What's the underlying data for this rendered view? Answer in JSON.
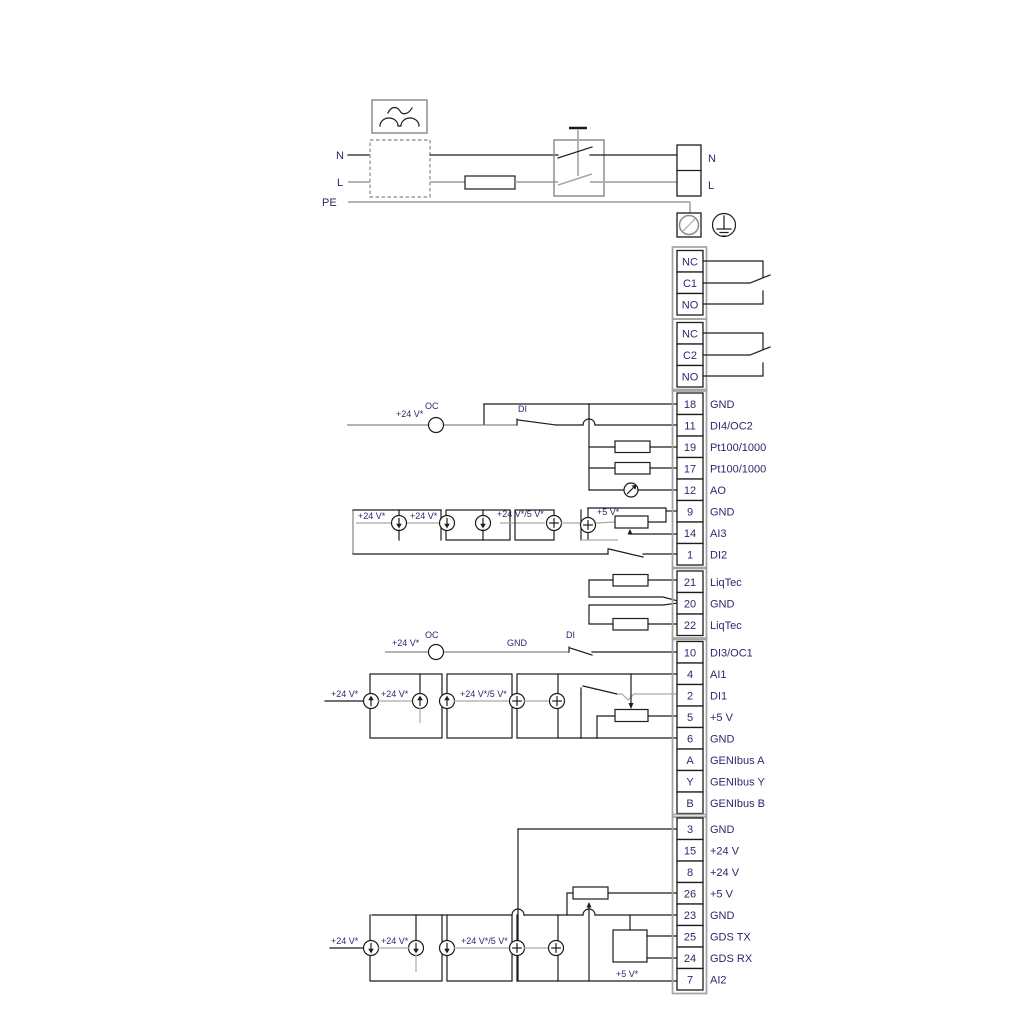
{
  "title": "pump-wiring-terminal-diagram",
  "colors": {
    "line_black": "#1c1c1c",
    "line_gray": "#a9a9a9",
    "text_navy": "#29296e",
    "housing_gray": "#a3a3a3",
    "background": "#ffffff"
  },
  "power": {
    "n_in": "N",
    "l_in": "L",
    "pe": "PE",
    "n_out": "N",
    "l_out": "L"
  },
  "relays": {
    "r1": [
      "NC",
      "C1",
      "NO"
    ],
    "r2": [
      "NC",
      "C2",
      "NO"
    ]
  },
  "terminals": {
    "main": [
      {
        "pin": "18",
        "label": "GND"
      },
      {
        "pin": "11",
        "label": "DI4/OC2"
      },
      {
        "pin": "19",
        "label": "Pt100/1000"
      },
      {
        "pin": "17",
        "label": "Pt100/1000"
      },
      {
        "pin": "12",
        "label": "AO"
      },
      {
        "pin": "9",
        "label": "GND"
      },
      {
        "pin": "14",
        "label": "AI3"
      },
      {
        "pin": "1",
        "label": "DI2"
      }
    ],
    "liqtec": [
      {
        "pin": "21",
        "label": "LiqTec"
      },
      {
        "pin": "20",
        "label": "GND"
      },
      {
        "pin": "22",
        "label": "LiqTec"
      }
    ],
    "io": [
      {
        "pin": "10",
        "label": "DI3/OC1"
      },
      {
        "pin": "4",
        "label": "AI1"
      },
      {
        "pin": "2",
        "label": "DI1"
      },
      {
        "pin": "5",
        "label": "+5 V"
      },
      {
        "pin": "6",
        "label": "GND"
      },
      {
        "pin": "A",
        "label": "GENIbus A"
      },
      {
        "pin": "Y",
        "label": "GENIbus Y"
      },
      {
        "pin": "B",
        "label": "GENIbus B"
      }
    ],
    "comm": [
      {
        "pin": "3",
        "label": "GND"
      },
      {
        "pin": "15",
        "label": "+24 V"
      },
      {
        "pin": "8",
        "label": "+24 V"
      },
      {
        "pin": "26",
        "label": "+5 V"
      },
      {
        "pin": "23",
        "label": "GND"
      },
      {
        "pin": "25",
        "label": "GDS TX"
      },
      {
        "pin": "24",
        "label": "GDS RX"
      },
      {
        "pin": "7",
        "label": "AI2"
      }
    ]
  },
  "ann": {
    "r18_v24": "+24 V*",
    "r18_oc": "OC",
    "r18_di": "DI",
    "r9_v24a": "+24 V*",
    "r9_v24b": "+24 V*",
    "r9_mix": "+24 V*/5 V*",
    "r9_v5": "+5 V*",
    "r10_v24": "+24 V*",
    "r10_oc": "OC",
    "r10_gnd": "GND",
    "r10_di": "DI",
    "r4_v24a": "+24 V*",
    "r4_v24b": "+24 V*",
    "r4_mix": "+24 V*/5 V*",
    "rb_v24a": "+24 V*",
    "rb_v24b": "+24 V*",
    "rb_mix": "+24 V*/5 V*",
    "rb_v5": "+5 V*"
  }
}
